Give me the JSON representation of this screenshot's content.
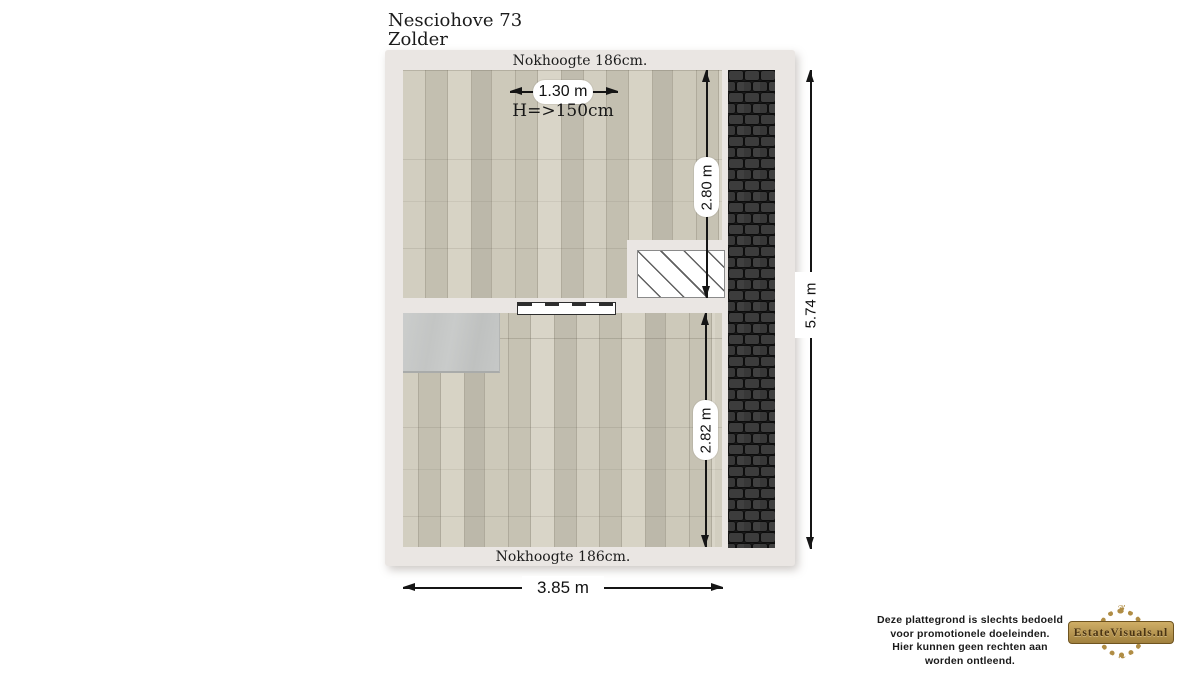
{
  "title": {
    "address": "Nesciohove 73",
    "floor": "Zolder"
  },
  "plan": {
    "top_note": "Nokhoogte 186cm.",
    "bottom_note": "Nokhoogte 186cm.",
    "height_note": "H=>150cm",
    "dim_opening_width": "1.30 m",
    "dim_upper_room_depth": "2.80 m",
    "dim_lower_room_depth": "2.82 m",
    "dim_total_depth": "5.74 m",
    "dim_total_width": "3.85 m"
  },
  "footer": {
    "disclaimer": [
      "Deze plattegrond is slechts bedoeld",
      "voor promotionele doeleinden.",
      "Hier kunnen geen rechten aan worden ontleend."
    ],
    "logo_text": "EstateVisuals.nl"
  },
  "colors": {
    "wall": "#eae6e3",
    "floor": "#cbc7b8",
    "roof": "#1a1a1a",
    "dim": "#151515",
    "gold": "#b08d45"
  }
}
